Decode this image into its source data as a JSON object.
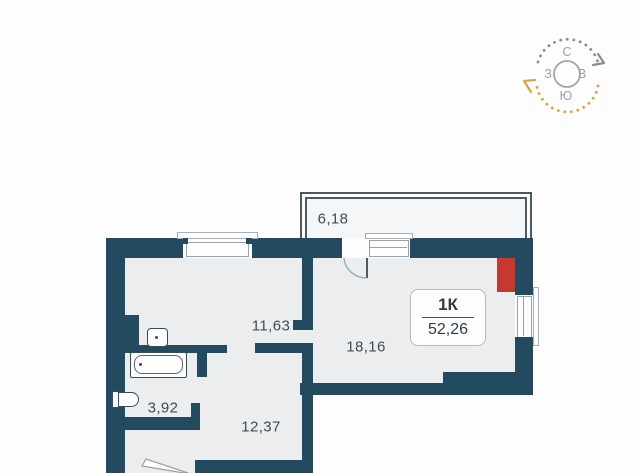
{
  "plan_title": "apartment floor plan",
  "apartment": {
    "type_label": "1К",
    "total_area": "52,26"
  },
  "rooms": [
    {
      "name": "balcony",
      "area": "6,18"
    },
    {
      "name": "living-kitchen",
      "area": "11,63"
    },
    {
      "name": "main-room",
      "area": "18,16"
    },
    {
      "name": "bathroom",
      "area": "3,92"
    },
    {
      "name": "hallway",
      "area": "12,37"
    }
  ],
  "compass": {
    "north": "С",
    "east": "В",
    "south": "Ю",
    "west": "З"
  },
  "colors": {
    "wall": "#234a5f",
    "floor": "#ebedef",
    "accent_red": "#c43a31",
    "compass_gray": "#868e93",
    "compass_orange": "#dfa242"
  }
}
